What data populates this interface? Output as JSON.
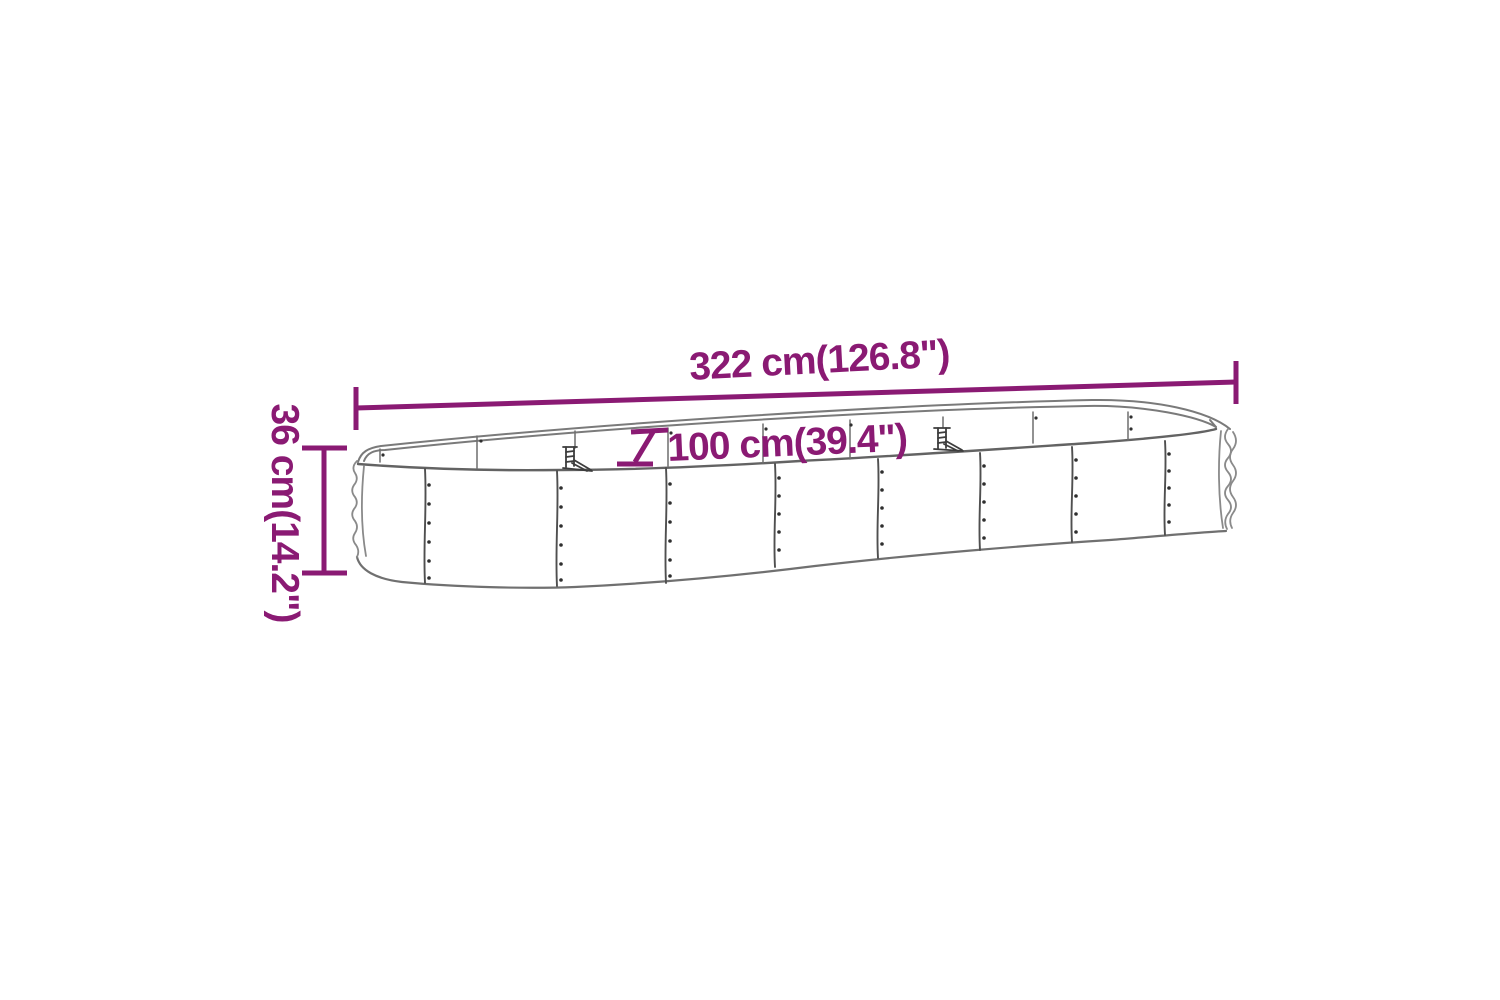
{
  "diagram": {
    "accent_color": "#8a1a73",
    "line_color": "#7a7a7a",
    "background": "#ffffff",
    "labels": {
      "length": "322 cm(126.8\")",
      "width": "100 cm(39.4\")",
      "height": "36 cm(14.2\")"
    }
  }
}
